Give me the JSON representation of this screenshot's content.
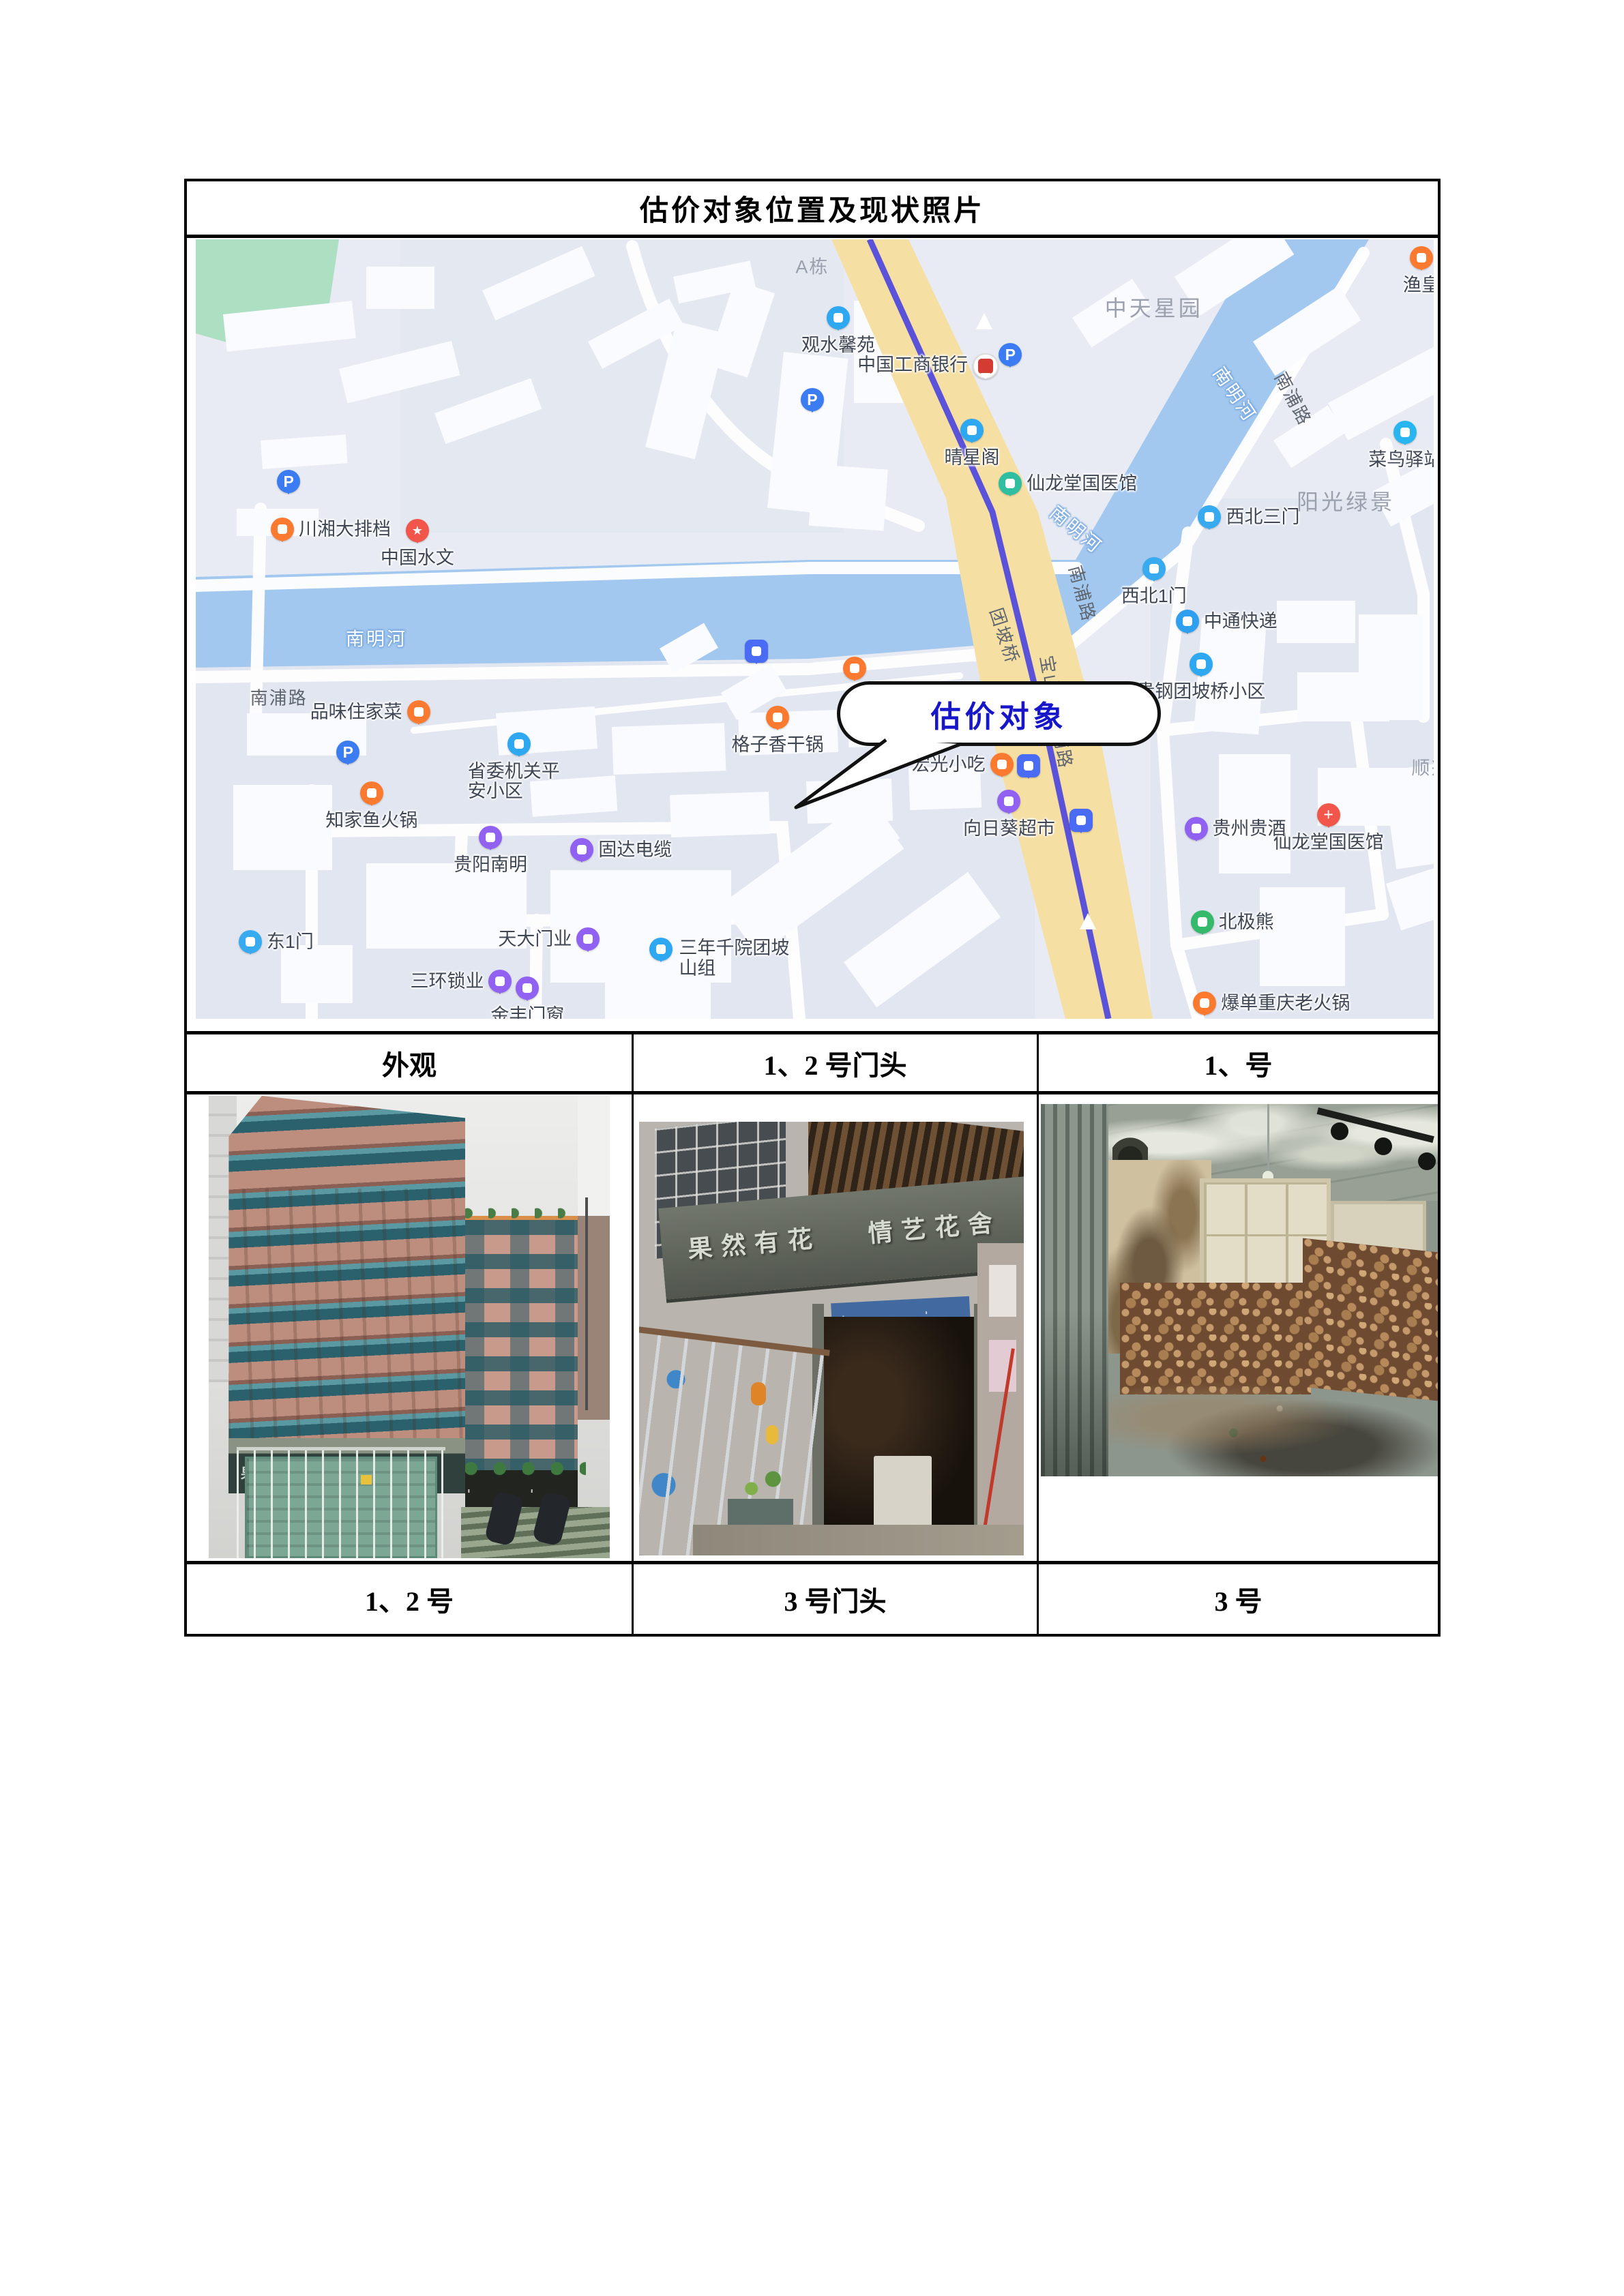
{
  "document": {
    "title": "估价对象位置及现状照片"
  },
  "table": {
    "headers": [
      "外观",
      "1、2 号门头",
      "1、号"
    ],
    "footers": [
      "1、2 号",
      "3 号门头",
      "3 号"
    ]
  },
  "map": {
    "callout": {
      "text": "估价对象"
    },
    "colors": {
      "background": "#e8ebf3",
      "river": "#a3c8ef",
      "main_road": "#f6dfa2",
      "main_road_line": "#5a52d8",
      "park": "#ade0c2",
      "callout_text": "#1717c9"
    },
    "pois": [
      {
        "label": "",
        "icon": "parking",
        "x": 7.5,
        "y": 31.1,
        "lp": "none"
      },
      {
        "label": "川湘大排档",
        "icon": "food",
        "x": 7.0,
        "y": 37.2,
        "lp": "right"
      },
      {
        "label": "中国水文",
        "icon": "gov",
        "x": 17.9,
        "y": 37.4,
        "lp": "below"
      },
      {
        "label": "",
        "icon": "parking",
        "x": 12.3,
        "y": 65.8,
        "lp": "none"
      },
      {
        "label": "品味住家菜",
        "icon": "food",
        "x": 18.0,
        "y": 60.6,
        "lp": "left"
      },
      {
        "label": "知家鱼火锅",
        "icon": "food",
        "x": 14.2,
        "y": 71.0,
        "lp": "below"
      },
      {
        "label": "省委机关平安小区",
        "icon": "residence",
        "x": 26.1,
        "y": 64.7,
        "lp": "below-wrap"
      },
      {
        "label": "贵阳南明",
        "icon": "shop",
        "x": 23.8,
        "y": 76.7,
        "lp": "below"
      },
      {
        "label": "固达电缆",
        "icon": "shop",
        "x": 31.2,
        "y": 78.3,
        "lp": "right"
      },
      {
        "label": "东1门",
        "icon": "gate",
        "x": 4.4,
        "y": 90.1,
        "lp": "right"
      },
      {
        "label": "天大门业",
        "icon": "shop",
        "x": 31.7,
        "y": 89.8,
        "lp": "left"
      },
      {
        "label": "三环锁业",
        "icon": "shop",
        "x": 24.6,
        "y": 95.2,
        "lp": "left"
      },
      {
        "label": "金丰门窗",
        "icon": "shop",
        "x": 26.8,
        "y": 96.1,
        "lp": "below"
      },
      {
        "label": "三年千院团坡山组",
        "icon": "residence",
        "x": 37.6,
        "y": 91.1,
        "lp": "right-wrap"
      },
      {
        "label": "观水馨苑",
        "icon": "residence",
        "x": 51.9,
        "y": 10.1,
        "lp": "below"
      },
      {
        "label": "",
        "icon": "parking",
        "x": 49.8,
        "y": 20.6,
        "lp": "none"
      },
      {
        "label": "",
        "icon": "bus",
        "x": 45.3,
        "y": 52.8,
        "lp": "none"
      },
      {
        "label": "格子香干锅",
        "icon": "food",
        "x": 47.0,
        "y": 61.3,
        "lp": "below"
      },
      {
        "label": "",
        "icon": "food",
        "x": 53.2,
        "y": 55.0,
        "lp": "none"
      },
      {
        "label": "宏光小吃",
        "icon": "food",
        "x": 65.1,
        "y": 67.4,
        "lp": "left"
      },
      {
        "label": "",
        "icon": "bus",
        "x": 67.3,
        "y": 67.5,
        "lp": "none"
      },
      {
        "label": "向日葵超市",
        "icon": "cart",
        "x": 65.7,
        "y": 72.1,
        "lp": "below"
      },
      {
        "label": "",
        "icon": "bus",
        "x": 71.5,
        "y": 74.5,
        "lp": "none"
      },
      {
        "label": "中国工商银行",
        "icon": "bank",
        "x": 63.7,
        "y": 16.1,
        "lp": "left"
      },
      {
        "label": "",
        "icon": "parking",
        "x": 65.8,
        "y": 14.8,
        "lp": "none"
      },
      {
        "label": "晴星阁",
        "icon": "residence",
        "x": 62.7,
        "y": 24.5,
        "lp": "below"
      },
      {
        "label": "仙龙堂国医馆",
        "icon": "clinic",
        "x": 65.8,
        "y": 31.3,
        "lp": "right"
      },
      {
        "label": "渔皇",
        "icon": "food",
        "x": 99.0,
        "y": 2.4,
        "lp": "below"
      },
      {
        "label": "菜鸟驿站",
        "icon": "station",
        "x": 97.7,
        "y": 24.8,
        "lp": "below"
      },
      {
        "label": "西北三门",
        "icon": "gate",
        "x": 81.9,
        "y": 35.6,
        "lp": "right"
      },
      {
        "label": "西北1门",
        "icon": "gate",
        "x": 77.4,
        "y": 42.3,
        "lp": "below"
      },
      {
        "label": "中通快递",
        "icon": "courier",
        "x": 80.1,
        "y": 49.0,
        "lp": "right"
      },
      {
        "label": "贵钢团坡桥小区",
        "icon": "residence",
        "x": 81.2,
        "y": 54.5,
        "lp": "below"
      },
      {
        "label": "仙龙堂国医馆",
        "icon": "hospital",
        "x": 91.5,
        "y": 73.8,
        "lp": "below"
      },
      {
        "label": "贵州贵酒",
        "icon": "shop",
        "x": 80.8,
        "y": 75.6,
        "lp": "right"
      },
      {
        "label": "北极熊",
        "icon": "scenic",
        "x": 81.3,
        "y": 87.6,
        "lp": "right"
      },
      {
        "label": "爆单重庆老火锅",
        "icon": "hotpot",
        "x": 81.5,
        "y": 98.0,
        "lp": "right"
      }
    ],
    "texts": [
      {
        "text": "A栋",
        "kind": "area-sm",
        "x": 49.8,
        "y": 3.3,
        "rot": 0
      },
      {
        "text": "中天星园",
        "kind": "area",
        "x": 77.4,
        "y": 8.7,
        "rot": 0
      },
      {
        "text": "阳光绿景",
        "kind": "area",
        "x": 92.9,
        "y": 33.5,
        "rot": 0
      },
      {
        "text": "顺兴",
        "kind": "area-sm",
        "x": 99.8,
        "y": 67.6,
        "rot": 0
      },
      {
        "text": "南浦路",
        "kind": "road",
        "x": 6.7,
        "y": 58.7,
        "rot": 0
      },
      {
        "text": "南浦路",
        "kind": "road",
        "x": 88.7,
        "y": 20.4,
        "rot": 62
      },
      {
        "text": "南浦路",
        "kind": "road",
        "x": 71.7,
        "y": 45.4,
        "rot": 75
      },
      {
        "text": "南明河",
        "kind": "river",
        "x": 14.6,
        "y": 51.1,
        "rot": 0
      },
      {
        "text": "南明河",
        "kind": "river",
        "x": 84.0,
        "y": 19.8,
        "rot": 56
      },
      {
        "text": "南明河",
        "kind": "river",
        "x": 71.2,
        "y": 37.1,
        "rot": 40
      },
      {
        "text": "团坡桥",
        "kind": "road",
        "x": 65.4,
        "y": 50.8,
        "rot": 72
      },
      {
        "text": "宝山南路辅路",
        "kind": "road",
        "x": 69.6,
        "y": 60.6,
        "rot": 80
      }
    ]
  },
  "photos": {
    "exterior": {
      "sign_left": "果然有花",
      "sign_right": "情艺花舍"
    },
    "storefront": {
      "sign_left": "果然有花",
      "sign_right": "情艺花舍"
    }
  }
}
